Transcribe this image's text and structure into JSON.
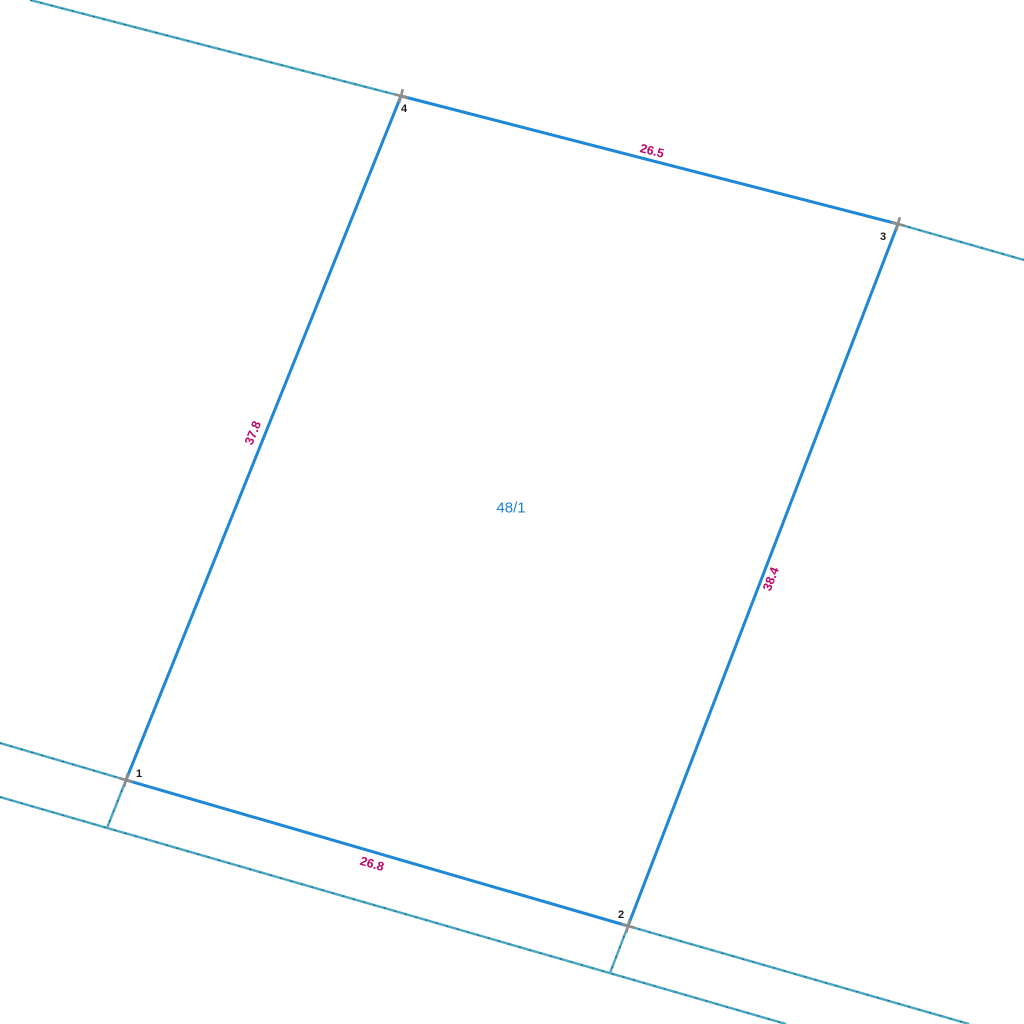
{
  "map": {
    "background_color": "#ffffff",
    "colors": {
      "parcel_edge": "#1e87d6",
      "adjacent_line": "#4aa7c2",
      "adjacent_line_dash": "#1a5a78",
      "dimension_label": "#c00568",
      "parcel_label": "#1e7fd0",
      "vertex_marker": "#8c8c8c",
      "vertex_label": "#1a1a1a"
    },
    "parcel": {
      "id_label": "48/1",
      "label_pos": {
        "x": 511,
        "y": 508
      },
      "vertices": [
        {
          "n": "1",
          "x": 126,
          "y": 780,
          "label_dx": 13,
          "label_dy": -6,
          "marker": "cross"
        },
        {
          "n": "2",
          "x": 628,
          "y": 926,
          "label_dx": -7,
          "label_dy": -11,
          "marker": "cross"
        },
        {
          "n": "3",
          "x": 898,
          "y": 224,
          "label_dx": -15,
          "label_dy": 13,
          "marker": "cross"
        },
        {
          "n": "4",
          "x": 401,
          "y": 96,
          "label_dx": 3,
          "label_dy": 13,
          "marker": "cross"
        }
      ],
      "edges": [
        {
          "from": "4",
          "to": "3",
          "length": "26.5",
          "label": {
            "x": 652,
            "y": 151,
            "angle": 14.5
          }
        },
        {
          "from": "3",
          "to": "2",
          "length": "38.4",
          "label": {
            "x": 771,
            "y": 579,
            "angle": -69
          }
        },
        {
          "from": "1",
          "to": "2",
          "length": "26.8",
          "label": {
            "x": 372,
            "y": 864,
            "angle": 16
          }
        },
        {
          "from": "4",
          "to": "1",
          "length": "37.8",
          "label": {
            "x": 253,
            "y": 433,
            "angle": -68
          }
        }
      ]
    },
    "adjacent_lines": [
      {
        "name": "top-boundary-extension-left",
        "x1": 30,
        "y1": 0,
        "x2": 401,
        "y2": 96
      },
      {
        "name": "top-boundary-extension-right",
        "x1": 898,
        "y1": 224,
        "x2": 1024,
        "y2": 260
      },
      {
        "name": "bottom-boundary-extension-left",
        "x1": 0,
        "y1": 743,
        "x2": 126,
        "y2": 780
      },
      {
        "name": "bottom-boundary-extension-right",
        "x1": 628,
        "y1": 926,
        "x2": 969,
        "y2": 1024
      },
      {
        "name": "lower-road-line",
        "x1": 0,
        "y1": 797,
        "x2": 786,
        "y2": 1024
      },
      {
        "name": "left-edge-extension-below-1",
        "x1": 126,
        "y1": 780,
        "x2": 107,
        "y2": 828
      },
      {
        "name": "right-edge-extension-below-2",
        "x1": 628,
        "y1": 926,
        "x2": 610,
        "y2": 973
      }
    ],
    "marker": {
      "size": 14,
      "rotation": 15,
      "stroke_width": 2.6
    }
  }
}
